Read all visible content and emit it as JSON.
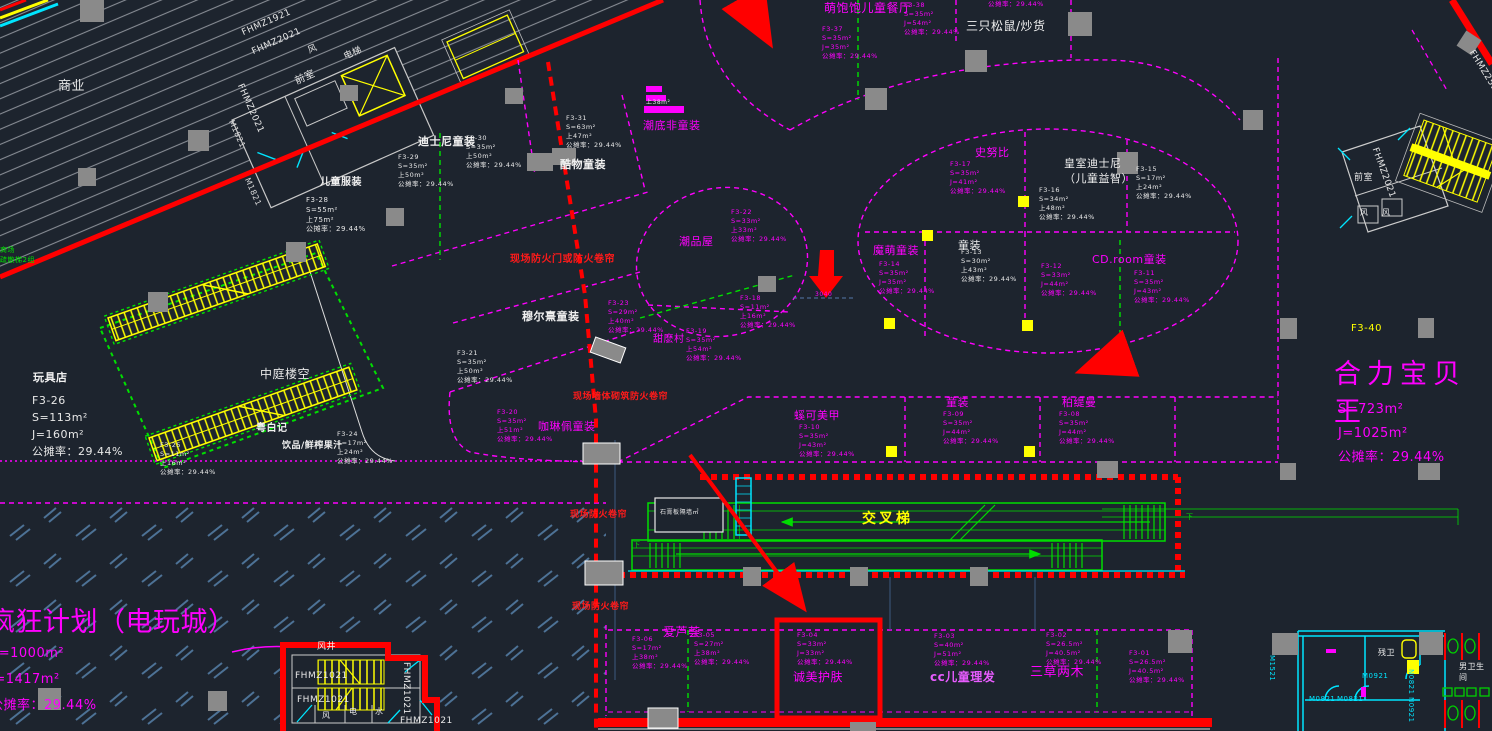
{
  "drawing": {
    "colors": {
      "background": "#1d242e",
      "shop_accent": "#ff00ff",
      "fire_note": "#ff1a1a",
      "escalator": "#00dd00",
      "stairs": "#ffff00",
      "walls": "#e8e8e8",
      "doors": "#00e5ff",
      "hatch": "#8b9098",
      "game_hatch": "#4d7296"
    },
    "shared_ratio_note": "公摊率：29.44%"
  },
  "labels": [
    {
      "name": "zone-shangye",
      "text": "商业",
      "x": 58,
      "y": 78,
      "c": "#e8e8e8",
      "fs": 13
    },
    {
      "name": "tag-fhmz1921",
      "text": "FHMZ1921",
      "x": 240,
      "y": 28,
      "c": "#e8e8e8",
      "fs": 9,
      "rot": -24
    },
    {
      "name": "tag-fhmz2021-a",
      "text": "FHMZ2021",
      "x": 250,
      "y": 47,
      "c": "#e8e8e8",
      "fs": 9,
      "rot": -24
    },
    {
      "name": "tag-fhmz2021-b",
      "text": "FHMZ2021",
      "x": 245,
      "y": 82,
      "c": "#e8e8e8",
      "fs": 9,
      "rot": 66
    },
    {
      "name": "tag-m1821-a",
      "text": "M1821",
      "x": 236,
      "y": 118,
      "c": "#dcdcdc",
      "fs": 8,
      "rot": 66
    },
    {
      "name": "tag-m1821-b",
      "text": "M1821",
      "x": 252,
      "y": 176,
      "c": "#dcdcdc",
      "fs": 8,
      "rot": 66
    },
    {
      "name": "room-qianshi-tl",
      "text": "前室",
      "x": 293,
      "y": 76,
      "c": "#e8e8e8",
      "fs": 10,
      "rot": -24
    },
    {
      "name": "room-feng-tl",
      "text": "风",
      "x": 306,
      "y": 46,
      "c": "#e8e8e8",
      "fs": 9,
      "rot": -24
    },
    {
      "name": "room-dianti-tl",
      "text": "电梯",
      "x": 342,
      "y": 52,
      "c": "#e8e8e8",
      "fs": 9,
      "rot": -24
    },
    {
      "name": "shop-ertong-fuzhuang",
      "text": "儿童服装",
      "x": 320,
      "y": 176,
      "c": "#f0f0f0",
      "fs": 10,
      "b": 1
    },
    {
      "name": "info-f3-28",
      "text": "F3-28\nS=55m²\n上75m²\n公摊率：29.44%",
      "x": 306,
      "y": 196,
      "c": "#e8e8e8",
      "fs": 7
    },
    {
      "name": "note-shuosan",
      "text": "商场\n疏散梯2组",
      "x": 0,
      "y": 246,
      "c": "#00e000",
      "fs": 7
    },
    {
      "name": "shop-wanjudian",
      "text": "玩具店",
      "x": 33,
      "y": 370,
      "c": "#f0f0f0",
      "fs": 11,
      "b": 1
    },
    {
      "name": "info-f3-26",
      "text": "F3-26\nS=113m²\nJ=160m²\n公摊率：29.44%",
      "x": 32,
      "y": 392,
      "c": "#e8e8e8",
      "fs": 11,
      "lh": 1.55
    },
    {
      "name": "zone-zhongting",
      "text": "中庭楼空",
      "x": 260,
      "y": 366,
      "c": "#e8e8e8",
      "fs": 12
    },
    {
      "name": "shop-yuebaiji",
      "text": "粤白记",
      "x": 256,
      "y": 422,
      "c": "#f0f0f0",
      "fs": 10,
      "b": 1
    },
    {
      "name": "shop-yinpin-guozhi",
      "text": "饮品/鲜榨果汁",
      "x": 282,
      "y": 440,
      "c": "#f0f0f0",
      "fs": 9,
      "b": 1
    },
    {
      "name": "info-f3-24",
      "text": "F3-24\nS=17m²\n上24m²\n公摊率：29.44%",
      "x": 337,
      "y": 430,
      "c": "#e8e8e8",
      "fs": 6.5
    },
    {
      "name": "info-f3-25",
      "text": "F3-25\nS=11m²\n上16m²\n公摊率：29.44%",
      "x": 160,
      "y": 441,
      "c": "#e8e8e8",
      "fs": 6.5
    },
    {
      "name": "tenant-dianwancheng",
      "text": "疯狂计划（电玩城）",
      "x": -12,
      "y": 604,
      "c": "#ff00ff",
      "fs": 27
    },
    {
      "name": "tenant-dianwancheng-s",
      "text": "S=1000m²",
      "x": -10,
      "y": 645,
      "c": "#ff00ff",
      "fs": 13
    },
    {
      "name": "tenant-dianwancheng-j",
      "text": "J=1417m²",
      "x": -10,
      "y": 671,
      "c": "#ff00ff",
      "fs": 13
    },
    {
      "name": "tenant-dianwancheng-ratio",
      "text": "公摊率：29.44%",
      "x": -10,
      "y": 697,
      "c": "#ff00ff",
      "fs": 13
    },
    {
      "name": "shop-disney-tongzhuang",
      "text": "迪士尼童装",
      "x": 418,
      "y": 134,
      "c": "#f0f0f0",
      "fs": 11,
      "b": 1
    },
    {
      "name": "info-f3-29",
      "text": "F3-29\nS=35m²\n上50m²\n公摊率：29.44%",
      "x": 398,
      "y": 153,
      "c": "#e8e8e8",
      "fs": 6.5
    },
    {
      "name": "info-f3-30",
      "text": "F3-30\nS=35m²\n上50m²\n公摊率：29.44%",
      "x": 466,
      "y": 134,
      "c": "#e8e8e8",
      "fs": 6.5
    },
    {
      "name": "shop-kuwu",
      "text": "酷物童装",
      "x": 560,
      "y": 157,
      "c": "#f0f0f0",
      "fs": 11,
      "b": 1
    },
    {
      "name": "info-f3-31",
      "text": "F3-31\nS=63m²\n上47m²\n公摊率：29.44%",
      "x": 566,
      "y": 114,
      "c": "#e8e8e8",
      "fs": 6.5
    },
    {
      "name": "info-shang38",
      "text": "上38m²",
      "x": 646,
      "y": 99,
      "c": "#e8e8e8",
      "fs": 6
    },
    {
      "name": "shop-chaodi",
      "text": "潮底非童装",
      "x": 643,
      "y": 118,
      "c": "#ff00ff",
      "fs": 11
    },
    {
      "name": "shop-chaopinwu",
      "text": "潮品屋",
      "x": 679,
      "y": 234,
      "c": "#ff00ff",
      "fs": 11
    },
    {
      "name": "info-f3-22",
      "text": "F3-22\nS=33m²\n上33m²\n公摊率：29.44%",
      "x": 731,
      "y": 208,
      "c": "#ff00ff",
      "fs": 6.5
    },
    {
      "name": "info-f3-23",
      "text": "F3-23\nS=29m²\n上40m²\n公摊率：29.44%",
      "x": 608,
      "y": 299,
      "c": "#ff00ff",
      "fs": 6.5
    },
    {
      "name": "shop-muerxi",
      "text": "穆尔熹童装",
      "x": 522,
      "y": 309,
      "c": "#f0f0f0",
      "fs": 11,
      "b": 1
    },
    {
      "name": "info-f3-21",
      "text": "F3-21\nS=35m²\n上50m²\n公摊率：29.44%",
      "x": 457,
      "y": 349,
      "c": "#e8e8e8",
      "fs": 6.5
    },
    {
      "name": "shop-tianmocun",
      "text": "甜麽村",
      "x": 653,
      "y": 333,
      "c": "#ff00ff",
      "fs": 10
    },
    {
      "name": "info-f3-19",
      "text": "F3-19\nS=35m²\n上54m²\n公摊率：29.44%",
      "x": 686,
      "y": 327,
      "c": "#ff00ff",
      "fs": 6.5
    },
    {
      "name": "info-f3-20",
      "text": "F3-20\nS=35m²\n上51m²\n公摊率：29.44%",
      "x": 497,
      "y": 408,
      "c": "#ff00ff",
      "fs": 6.5
    },
    {
      "name": "shop-kalinpei",
      "text": "咖琳佩童装",
      "x": 538,
      "y": 419,
      "c": "#ff00ff",
      "fs": 11
    },
    {
      "name": "info-f3-18",
      "text": "F3-18\nS=11m²\n上16m²\n公摊率：29.44%",
      "x": 740,
      "y": 294,
      "c": "#ff00ff",
      "fs": 6.5
    },
    {
      "name": "dim-3040",
      "text": "3040",
      "x": 815,
      "y": 291,
      "c": "#ff00ff",
      "fs": 6
    },
    {
      "name": "shop-snoopy",
      "text": "史努比",
      "x": 975,
      "y": 145,
      "c": "#ff00ff",
      "fs": 11
    },
    {
      "name": "info-f3-17",
      "text": "F3-17\nS=35m²\nJ=41m²\n公摊率：29.44%",
      "x": 950,
      "y": 160,
      "c": "#ff00ff",
      "fs": 6.5
    },
    {
      "name": "shop-royal-disney",
      "text": "皇室迪士尼\n（儿童益智）",
      "x": 1064,
      "y": 156,
      "c": "#f0f0f0",
      "fs": 11
    },
    {
      "name": "info-f3-15",
      "text": "F3-15\nS=17m²\n上24m²\n公摊率：29.44%",
      "x": 1136,
      "y": 165,
      "c": "#e8e8e8",
      "fs": 6.5
    },
    {
      "name": "info-f3-16",
      "text": "F3-16\nS=34m²\n上48m²\n公摊率：29.44%",
      "x": 1039,
      "y": 186,
      "c": "#e8e8e8",
      "fs": 6.5
    },
    {
      "name": "shop-momeng",
      "text": "魔萌童装",
      "x": 873,
      "y": 243,
      "c": "#ff00ff",
      "fs": 11
    },
    {
      "name": "info-f3-14",
      "text": "F3-14\nS=35m²\nJ=35m²\n公摊率：29.44%",
      "x": 879,
      "y": 260,
      "c": "#ff00ff",
      "fs": 6.5
    },
    {
      "name": "shop-tongzhuang-1",
      "text": "童装",
      "x": 958,
      "y": 238,
      "c": "#f0f0f0",
      "fs": 11
    },
    {
      "name": "info-f3-13",
      "text": "F3-13\nS=30m²\n上43m²\n公摊率：29.44%",
      "x": 961,
      "y": 248,
      "c": "#e8e8e8",
      "fs": 6.5
    },
    {
      "name": "info-f3-12",
      "text": "F3-12\nS=33m²\nJ=44m²\n公摊率：29.44%",
      "x": 1041,
      "y": 262,
      "c": "#ff00ff",
      "fs": 6.5
    },
    {
      "name": "shop-cdroom",
      "text": "CD.room童装",
      "x": 1092,
      "y": 252,
      "c": "#ff00ff",
      "fs": 11
    },
    {
      "name": "info-f3-11",
      "text": "F3-11\nS=35m²\nJ=43m²\n公摊率：29.44%",
      "x": 1134,
      "y": 269,
      "c": "#ff00ff",
      "fs": 6.5
    },
    {
      "name": "shop-mengbaobao",
      "text": "萌饱饱儿童餐厅",
      "x": 824,
      "y": 0,
      "c": "#ff00ff",
      "fs": 12
    },
    {
      "name": "info-f3-37",
      "text": "F3-37\nS=35m²\nJ=35m²\n公摊率：29.44%",
      "x": 822,
      "y": 25,
      "c": "#ff00ff",
      "fs": 6.5
    },
    {
      "name": "info-f3-38",
      "text": "F3-38\nS=35m²\nJ=54m²\n公摊率：29.44%",
      "x": 904,
      "y": 1,
      "c": "#ff00ff",
      "fs": 6.5
    },
    {
      "name": "info-f3-39-partial",
      "text": "公摊率：29.44%",
      "x": 988,
      "y": 0,
      "c": "#ff00ff",
      "fs": 6.5
    },
    {
      "name": "shop-sanzhi-songshu",
      "text": "三只松鼠/炒货",
      "x": 966,
      "y": 18,
      "c": "#f0f0f0",
      "fs": 12
    },
    {
      "name": "tag-f3-40",
      "text": "F3-40",
      "x": 1351,
      "y": 322,
      "c": "#ffff00",
      "fs": 10
    },
    {
      "name": "tenant-heli-baobeiwang",
      "text": "合力宝贝王",
      "x": 1334,
      "y": 356,
      "c": "#ff00ff",
      "fs": 27,
      "ls": 6
    },
    {
      "name": "tenant-heli-s",
      "text": "S=723m²",
      "x": 1338,
      "y": 401,
      "c": "#ff00ff",
      "fs": 13
    },
    {
      "name": "tenant-heli-j",
      "text": "J=1025m²",
      "x": 1338,
      "y": 425,
      "c": "#ff00ff",
      "fs": 13
    },
    {
      "name": "tenant-heli-ratio",
      "text": "公摊率：29.44%",
      "x": 1338,
      "y": 449,
      "c": "#ff00ff",
      "fs": 13
    },
    {
      "name": "fire-note-1",
      "text": "现场防火门或防火卷帘",
      "x": 510,
      "y": 253,
      "c": "#ff1a1a",
      "fs": 10,
      "b": 1
    },
    {
      "name": "fire-note-2",
      "text": "现场墙体砌筑防火卷帘",
      "x": 573,
      "y": 391,
      "c": "#ff1a1a",
      "fs": 9,
      "b": 1
    },
    {
      "name": "fire-note-3",
      "text": "现场防火卷帘",
      "x": 570,
      "y": 509,
      "c": "#ff1a1a",
      "fs": 9,
      "b": 1
    },
    {
      "name": "fire-note-4",
      "text": "现场防火卷帘",
      "x": 572,
      "y": 601,
      "c": "#ff1a1a",
      "fs": 9,
      "b": 1
    },
    {
      "name": "escalator-jiaochati",
      "text": "交叉梯",
      "x": 862,
      "y": 510,
      "c": "#ffff00",
      "fs": 14,
      "b": 1,
      "ls": 3
    },
    {
      "name": "note-shigaoban",
      "text": "石膏板隔墙㎡",
      "x": 660,
      "y": 509,
      "c": "#e8e8e8",
      "fs": 6
    },
    {
      "name": "marker-xia-1",
      "text": "下",
      "x": 1186,
      "y": 513,
      "c": "#00dd00",
      "fs": 7
    },
    {
      "name": "marker-xia-2",
      "text": "下",
      "x": 633,
      "y": 541,
      "c": "#00dd00",
      "fs": 7
    },
    {
      "name": "shop-meijia",
      "text": "螇可美甲",
      "x": 794,
      "y": 408,
      "c": "#ff00ff",
      "fs": 11
    },
    {
      "name": "info-f3-10",
      "text": "F3-10\nS=35m²\nJ=43m²\n公摊率：29.44%",
      "x": 799,
      "y": 423,
      "c": "#ff00ff",
      "fs": 6.5
    },
    {
      "name": "shop-tongzhuang-2",
      "text": "童装",
      "x": 946,
      "y": 395,
      "c": "#ff00ff",
      "fs": 11
    },
    {
      "name": "info-f3-09",
      "text": "F3-09\nS=35m²\nJ=44m²\n公摊率：29.44%",
      "x": 943,
      "y": 410,
      "c": "#ff00ff",
      "fs": 6.5
    },
    {
      "name": "shop-botiman",
      "text": "柏缇曼",
      "x": 1062,
      "y": 395,
      "c": "#ff00ff",
      "fs": 11
    },
    {
      "name": "info-f3-08",
      "text": "F3-08\nS=35m²\nJ=44m²\n公摊率：29.44%",
      "x": 1059,
      "y": 410,
      "c": "#ff00ff",
      "fs": 6.5
    },
    {
      "name": "shop-ailuhui",
      "text": "爱芦荟",
      "x": 663,
      "y": 624,
      "c": "#ff00ff",
      "fs": 12
    },
    {
      "name": "info-f3-06",
      "text": "F3-06\nS=17m²\n上38m²\n公摊率：29.44%",
      "x": 632,
      "y": 635,
      "c": "#ff00ff",
      "fs": 6.5
    },
    {
      "name": "info-f3-05",
      "text": "F3-05\nS=27m²\n上38m²\n公摊率：29.44%",
      "x": 694,
      "y": 631,
      "c": "#ff00ff",
      "fs": 6.5
    },
    {
      "name": "info-f3-04",
      "text": "F3-04\nS=33m²\nJ=33m²\n公摊率：29.44%",
      "x": 797,
      "y": 631,
      "c": "#ff00ff",
      "fs": 6.5
    },
    {
      "name": "shop-chengmei",
      "text": "诚美护肤",
      "x": 793,
      "y": 669,
      "c": "#ff00ff",
      "fs": 12
    },
    {
      "name": "info-f3-03",
      "text": "F3-03\nS=40m²\nJ=51m²\n公摊率：29.44%",
      "x": 934,
      "y": 632,
      "c": "#ff00ff",
      "fs": 6.5
    },
    {
      "name": "shop-cc-lifa",
      "text": "cc儿童理发",
      "x": 930,
      "y": 669,
      "c": "#e85cff",
      "fs": 12,
      "b": 1
    },
    {
      "name": "info-f3-02",
      "text": "F3-02\nS=26.5m²\nJ=40.5m²\n公摊率：29.44%",
      "x": 1046,
      "y": 631,
      "c": "#ff00ff",
      "fs": 6.5
    },
    {
      "name": "shop-sancao",
      "text": "三草两木",
      "x": 1030,
      "y": 664,
      "c": "#ff00ff",
      "fs": 13
    },
    {
      "name": "info-f3-01",
      "text": "F3-01\nS=26.5m²\nJ=40.5m²\n公摊率：29.44%",
      "x": 1129,
      "y": 649,
      "c": "#ff00ff",
      "fs": 6.5
    },
    {
      "name": "room-fengjing",
      "text": "风井",
      "x": 317,
      "y": 641,
      "c": "#f0f0f0",
      "fs": 9
    },
    {
      "name": "tag-fhmz1021-a",
      "text": "FHMZ1021",
      "x": 295,
      "y": 670,
      "c": "#e8e8e8",
      "fs": 9
    },
    {
      "name": "tag-fhmz1021-b",
      "text": "FHMZ1021",
      "x": 297,
      "y": 694,
      "c": "#e8e8e8",
      "fs": 9
    },
    {
      "name": "tag-fhmz1021-c",
      "text": "FHMZ1021",
      "x": 412,
      "y": 662,
      "c": "#e8e8e8",
      "fs": 9,
      "rot": 90
    },
    {
      "name": "tag-fhmz1021-d",
      "text": "FHMZ1021",
      "x": 400,
      "y": 715,
      "c": "#e8e8e8",
      "fs": 9
    },
    {
      "name": "room-feng-b",
      "text": "风",
      "x": 322,
      "y": 710,
      "c": "#e8e8e8",
      "fs": 8
    },
    {
      "name": "room-dian",
      "text": "电",
      "x": 349,
      "y": 706,
      "c": "#e8e8e8",
      "fs": 8
    },
    {
      "name": "room-shui",
      "text": "水",
      "x": 375,
      "y": 706,
      "c": "#e8e8e8",
      "fs": 8
    },
    {
      "name": "room-canwei",
      "text": "残卫",
      "x": 1378,
      "y": 647,
      "c": "#f0f0f0",
      "fs": 8
    },
    {
      "name": "tag-m0921",
      "text": "M0921",
      "x": 1362,
      "y": 672,
      "c": "#00e5ff",
      "fs": 7
    },
    {
      "name": "tag-m0821-a",
      "text": "M0821",
      "x": 1309,
      "y": 695,
      "c": "#00e5ff",
      "fs": 7
    },
    {
      "name": "tag-m0821-b",
      "text": "M0821",
      "x": 1337,
      "y": 695,
      "c": "#00e5ff",
      "fs": 7
    },
    {
      "name": "tag-m1521",
      "text": "M1521",
      "x": 1276,
      "y": 655,
      "c": "#00e5ff",
      "fs": 7,
      "rot": 90
    },
    {
      "name": "tag-n0821",
      "text": "N0821",
      "x": 1415,
      "y": 669,
      "c": "#00e5ff",
      "fs": 7,
      "rot": 90
    },
    {
      "name": "tag-n0921",
      "text": "N0921",
      "x": 1415,
      "y": 697,
      "c": "#00e5ff",
      "fs": 7,
      "rot": 90
    },
    {
      "name": "room-nanwei",
      "text": "男卫生间",
      "x": 1459,
      "y": 661,
      "c": "#f0f0f0",
      "fs": 8
    },
    {
      "name": "tag-fhmz2521",
      "text": "FHMZ2521",
      "x": 1476,
      "y": 48,
      "c": "#e8e8e8",
      "fs": 9,
      "rot": 58
    },
    {
      "name": "tag-fhmz2021-tr",
      "text": "FHMZ2021",
      "x": 1380,
      "y": 146,
      "c": "#e8e8e8",
      "fs": 9,
      "rot": 70
    },
    {
      "name": "room-qianshi-tr",
      "text": "前室",
      "x": 1354,
      "y": 172,
      "c": "#e8e8e8",
      "fs": 9
    },
    {
      "name": "room-feng-tr1",
      "text": "风",
      "x": 1360,
      "y": 207,
      "c": "#e8e8e8",
      "fs": 8
    },
    {
      "name": "room-feng-tr2",
      "text": "风",
      "x": 1382,
      "y": 207,
      "c": "#e8e8e8",
      "fs": 8
    }
  ]
}
